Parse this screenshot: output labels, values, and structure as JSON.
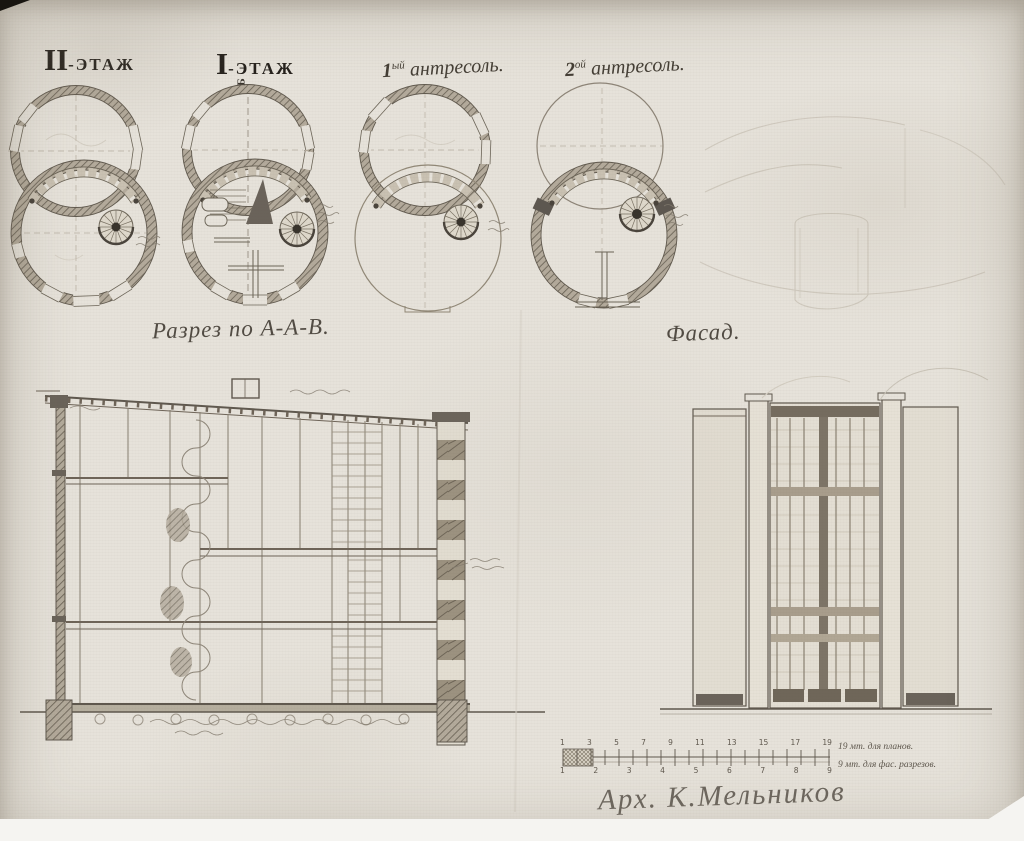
{
  "labels": {
    "plan1_num": "II",
    "plan1_rest": "-ЭТАЖ",
    "plan2_num": "I",
    "plan2_rest": "-ЭТАЖ",
    "plan3_num": "1",
    "plan3_sup": "ый",
    "plan3_rest": " антресоль.",
    "plan4_num": "2",
    "plan4_sup": "ой",
    "plan4_rest": " антресоль.",
    "marker_b": "Б",
    "section": "Разрез по А-А-В.",
    "facade": "Фасад."
  },
  "scale_bar": {
    "top_numbers": [
      "1",
      "3",
      "5",
      "7",
      "9",
      "11",
      "13",
      "15",
      "17",
      "19"
    ],
    "bottom_numbers": [
      "1",
      "2",
      "3",
      "4",
      "5",
      "6",
      "7",
      "8",
      "9"
    ],
    "top_note": "19 мт. для планов.",
    "bottom_note": "9 мт. для фас. разрезов."
  },
  "signature": "Арх. К.Мельников",
  "colors": {
    "ink": "#5f584e",
    "pencil": "#8d8477",
    "paper": "#e6e2da"
  }
}
